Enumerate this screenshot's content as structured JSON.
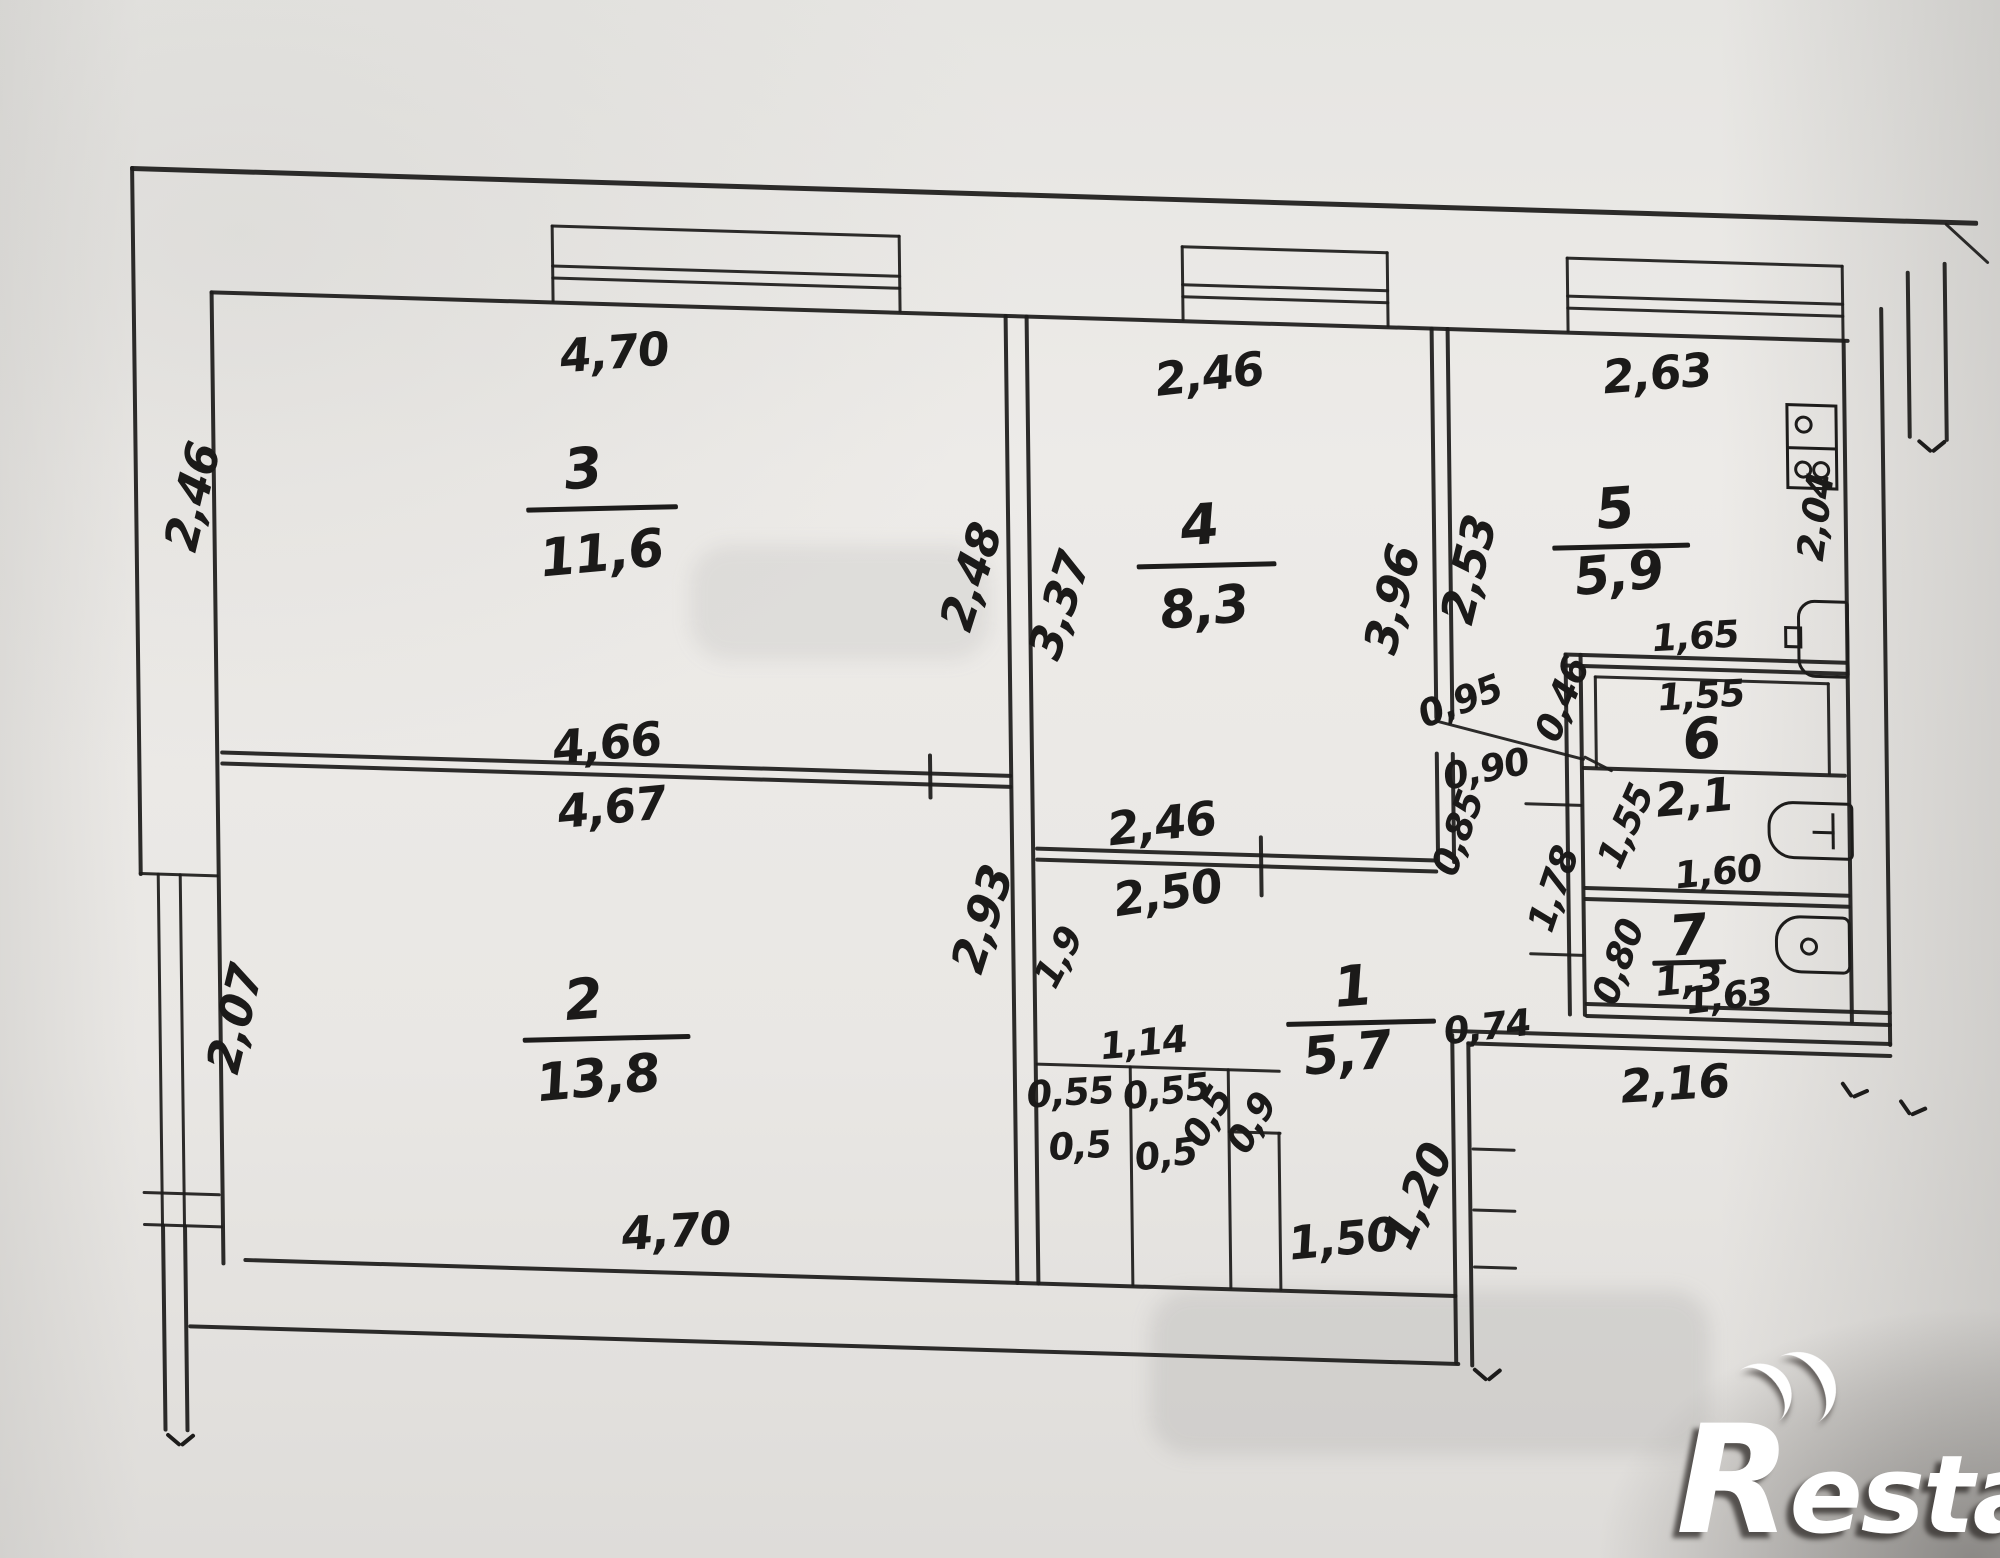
{
  "watermark": {
    "brand": "Restate",
    "brand_r": "R",
    "brand_rest": "estate"
  },
  "rooms": [
    {
      "id": "room-3",
      "number": "3",
      "area": "11,6",
      "ncx": 449,
      "ncy": 296,
      "ux": 392,
      "uy": 332,
      "uw": 152,
      "acx": 467,
      "acy": 380
    },
    {
      "id": "room-2",
      "number": "2",
      "area": "13,8",
      "ncx": 443,
      "ncy": 827,
      "ux": 382,
      "uy": 862,
      "uw": 168,
      "acx": 457,
      "acy": 905
    },
    {
      "id": "room-4",
      "number": "4",
      "area": "8,3",
      "ncx": 1065,
      "ncy": 334,
      "ux": 1002,
      "uy": 371,
      "uw": 140,
      "acx": 1069,
      "acy": 416
    },
    {
      "id": "room-5",
      "number": "5",
      "area": "5,9",
      "ncx": 1481,
      "ncy": 305,
      "ux": 1418,
      "uy": 340,
      "uw": 138,
      "acx": 1484,
      "acy": 370
    },
    {
      "id": "room-1",
      "number": "1",
      "area": "5,7",
      "ncx": 1213,
      "ncy": 791,
      "ux": 1146,
      "uy": 824,
      "uw": 150,
      "acx": 1207,
      "acy": 858
    },
    {
      "id": "room-6",
      "number": "6",
      "area": "2,1",
      "ncx": 1565,
      "ncy": 533,
      "ux": 0,
      "uy": 0,
      "uw": 0,
      "acx": 1557,
      "acy": 591
    },
    {
      "id": "room-7",
      "number": "7",
      "area": "1,3",
      "ncx": 1549,
      "ncy": 730,
      "ux": 1513,
      "uy": 754,
      "uw": 74,
      "acx": 1549,
      "acy": 774
    }
  ],
  "dimensions": [
    {
      "t": "4,70",
      "x": 482,
      "y": 178,
      "r": -6,
      "s": "md"
    },
    {
      "t": "2,46",
      "x": 1077,
      "y": 182,
      "r": -8,
      "s": "md"
    },
    {
      "t": "2,63",
      "x": 1525,
      "y": 168,
      "r": -6,
      "s": "md"
    },
    {
      "t": "2,46",
      "x": 58,
      "y": 335,
      "r": -76,
      "s": "md"
    },
    {
      "t": "2,48",
      "x": 836,
      "y": 392,
      "r": -72,
      "s": "md"
    },
    {
      "t": "3,37",
      "x": 924,
      "y": 418,
      "r": -72,
      "s": "md"
    },
    {
      "t": "3,96",
      "x": 1257,
      "y": 402,
      "r": -76,
      "s": "md"
    },
    {
      "t": "2,53",
      "x": 1334,
      "y": 370,
      "r": -76,
      "s": "md"
    },
    {
      "t": "2,04",
      "x": 1682,
      "y": 307,
      "r": -82,
      "s": "sm"
    },
    {
      "t": "1,65",
      "x": 1560,
      "y": 430,
      "r": -5,
      "s": "sm"
    },
    {
      "t": "1,55",
      "x": 1565,
      "y": 489,
      "r": -5,
      "s": "sm"
    },
    {
      "t": "1,55",
      "x": 1488,
      "y": 622,
      "r": -66,
      "s": "sm"
    },
    {
      "t": "1,60",
      "x": 1580,
      "y": 665,
      "r": -7,
      "s": "sm"
    },
    {
      "t": "0,80",
      "x": 1479,
      "y": 758,
      "r": -70,
      "s": "sm"
    },
    {
      "t": "1,63",
      "x": 1589,
      "y": 789,
      "r": -9,
      "s": "sm"
    },
    {
      "t": "2,16",
      "x": 1534,
      "y": 878,
      "r": -5,
      "s": "md"
    },
    {
      "t": "0,74",
      "x": 1347,
      "y": 827,
      "r": -8,
      "s": "sm"
    },
    {
      "t": "0,46",
      "x": 1426,
      "y": 497,
      "r": -68,
      "s": "sm"
    },
    {
      "t": "1,78",
      "x": 1415,
      "y": 687,
      "r": -71,
      "s": "sm"
    },
    {
      "t": "0,95",
      "x": 1324,
      "y": 502,
      "r": -22,
      "s": "sm"
    },
    {
      "t": "0,90",
      "x": 1349,
      "y": 569,
      "r": -13,
      "s": "sm"
    },
    {
      "t": "0,85",
      "x": 1320,
      "y": 634,
      "r": -70,
      "s": "sm"
    },
    {
      "t": "2,46",
      "x": 1024,
      "y": 633,
      "r": -8,
      "s": "md"
    },
    {
      "t": "2,50",
      "x": 1029,
      "y": 702,
      "r": -10,
      "s": "md"
    },
    {
      "t": "1,9",
      "x": 919,
      "y": 770,
      "r": -62,
      "s": "sm"
    },
    {
      "t": "2,93",
      "x": 843,
      "y": 734,
      "r": -72,
      "s": "md"
    },
    {
      "t": "4,66",
      "x": 470,
      "y": 569,
      "r": -7,
      "s": "md"
    },
    {
      "t": "4,67",
      "x": 474,
      "y": 633,
      "r": -7,
      "s": "md"
    },
    {
      "t": "2,07",
      "x": 94,
      "y": 856,
      "r": -76,
      "s": "md"
    },
    {
      "t": "1,14",
      "x": 1003,
      "y": 853,
      "r": -7,
      "s": "sm"
    },
    {
      "t": "0,55",
      "x": 929,
      "y": 905,
      "r": -5,
      "s": "sm"
    },
    {
      "t": "0,55",
      "x": 1025,
      "y": 901,
      "r": -9,
      "s": "sm"
    },
    {
      "t": "0,5",
      "x": 938,
      "y": 958,
      "r": -5,
      "s": "sm"
    },
    {
      "t": "0,5",
      "x": 1024,
      "y": 964,
      "r": -9,
      "s": "sm"
    },
    {
      "t": "0,5",
      "x": 1066,
      "y": 925,
      "r": -60,
      "s": "sm"
    },
    {
      "t": "0,9",
      "x": 1110,
      "y": 930,
      "r": -60,
      "s": "sm"
    },
    {
      "t": "1,50",
      "x": 1200,
      "y": 1043,
      "r": -7,
      "s": "md"
    },
    {
      "t": "1,20",
      "x": 1275,
      "y": 998,
      "r": -66,
      "s": "md"
    },
    {
      "t": "4,70",
      "x": 533,
      "y": 1055,
      "r": -5,
      "s": "md"
    }
  ],
  "fixtures": [
    "stove",
    "sink",
    "bathtub",
    "toilet"
  ]
}
